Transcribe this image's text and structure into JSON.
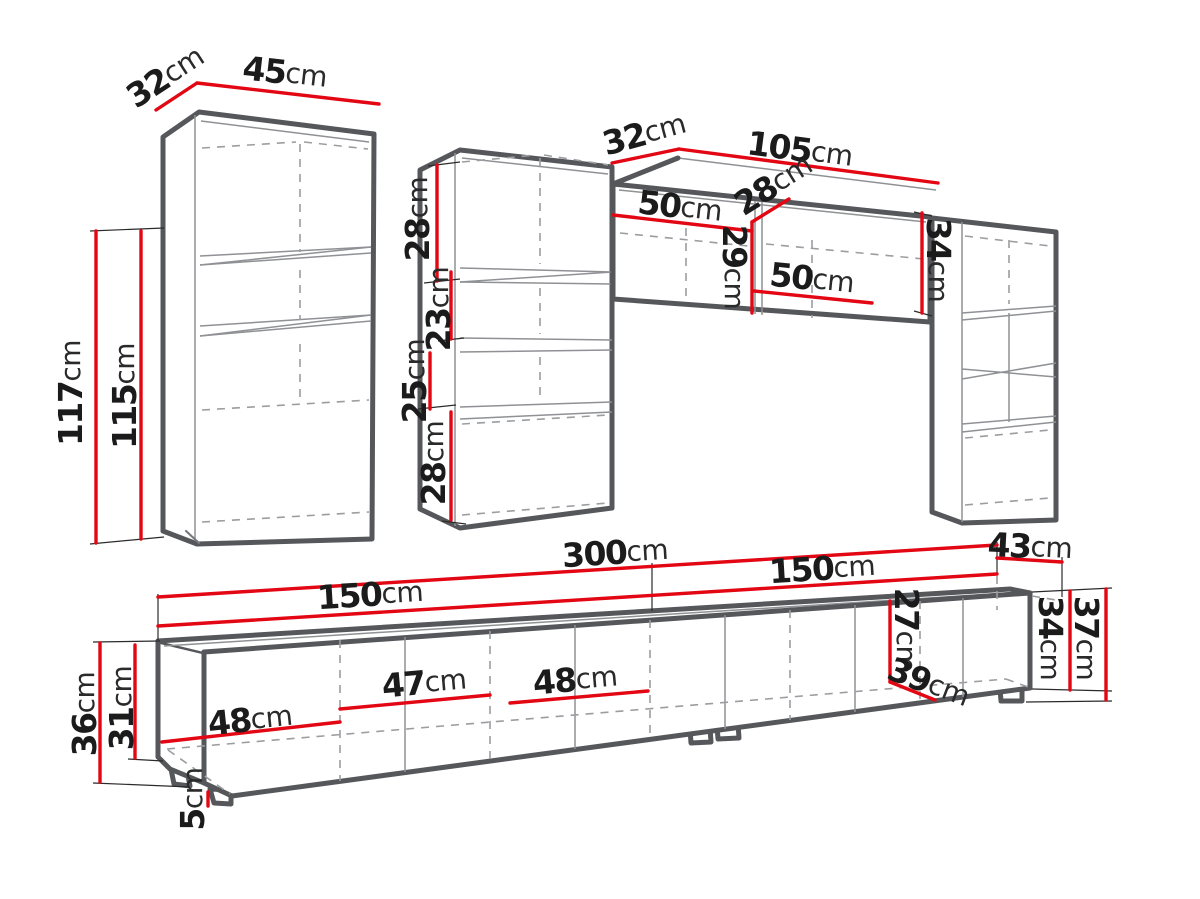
{
  "unit": "cm",
  "colors": {
    "dimension_line": "#e30613",
    "outline": "#55575b",
    "text": "#1b1b1b",
    "background": "#ffffff"
  },
  "cabinets": {
    "tall_left": {
      "depth": "32",
      "width": "45",
      "height_total": "117",
      "height_body": "115"
    },
    "tall_middle": {
      "top_section": "28",
      "shelf_gap_upper": "23",
      "shelf_gap_lower": "25",
      "bottom_section": "28"
    },
    "wall_horizontal": {
      "depth": "32",
      "width": "105",
      "inner_width_left": "50",
      "inner_depth": "28",
      "inner_height": "29",
      "inner_width_right": "50",
      "height": "34"
    },
    "tv_stand": {
      "width_total": "300",
      "width_left": "150",
      "width_right": "150",
      "depth": "43",
      "door_1": "48",
      "door_2": "47",
      "door_3": "48",
      "height_total": "36",
      "height_body": "31",
      "leg_height": "5",
      "inner_height": "27",
      "inner_depth": "39",
      "height_right_body": "34",
      "height_right_total": "37"
    }
  }
}
